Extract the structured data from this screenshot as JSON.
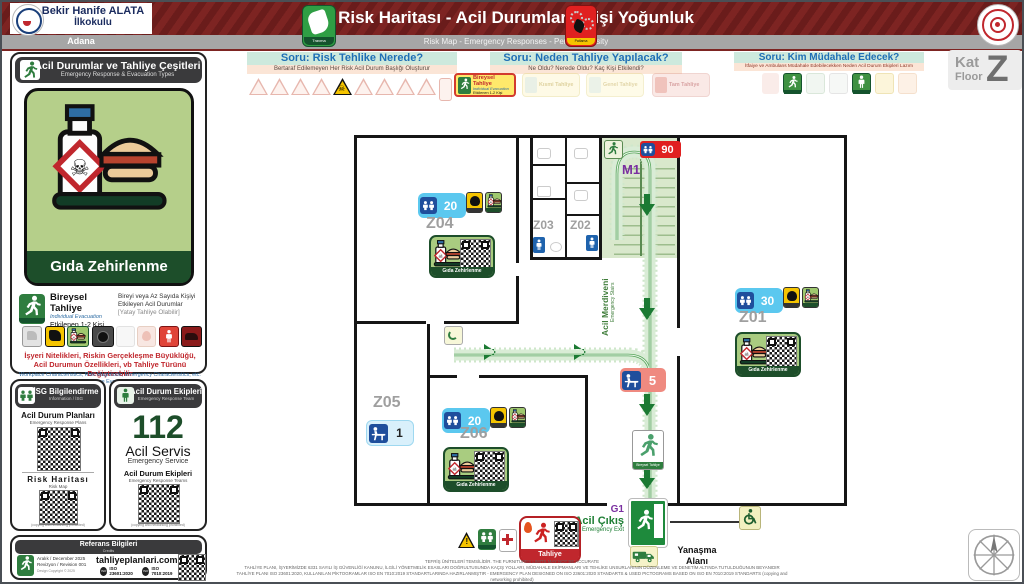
{
  "header": {
    "school_line1": "Bekir Hanife ALATA",
    "school_line2": "İlkokulu",
    "city": "Adana",
    "title": "Risk Haritası - Acil Durumlar - Kişi Yoğunluk",
    "subtitle": "Risk Map - Emergency Responses - Person Density",
    "travma_label": "Travma",
    "patlama_label": "Patlama"
  },
  "floor_badge": {
    "kat": "Kat",
    "floor": "Floor",
    "letter": "Z"
  },
  "questions": [
    {
      "title": "Soru: Risk Tehlike Nerede?",
      "subtitle": "Bertaraf Edilemeyen Her Risk Acil Durum Başlığı Oluşturur"
    },
    {
      "title": "Soru: Neden Tahliye Yapılacak?",
      "subtitle": "Ne Oldu? Nerede Oldu? Kaç Kişi Etkilendi?"
    },
    {
      "title": "Soru: Kim Müdahale Edecek?",
      "subtitle": "İtfaiye ve Ambulans Müdahale Edebilecekken Neden Acil Durum Ekipleri Lazım"
    }
  ],
  "evac_chips": {
    "active": {
      "title": "Bireysel Tahliye",
      "subtitle": "Individual Evacuation",
      "detail": "Etkilenen 1-2 Kişi"
    },
    "faded1": {
      "title": "Kısmi Tahliye"
    },
    "faded2": {
      "title": "Genel Tahliye"
    },
    "faded3": {
      "title": "Tam Tahliye"
    }
  },
  "sidebar": {
    "types": {
      "title": "Acil Durumlar ve Tahliye Çeşitleri",
      "subtitle": "Emergency Response & Evacuation Types",
      "hazard_label": "Gıda Zehirlenme",
      "evac_title": "Bireysel Tahliye",
      "evac_subtitle": "Individual Evacuation",
      "evac_detail": "Etkilenen 1-2 Kişi",
      "evac_desc1": "Bireyi veya Az Sayıda Kişiyi",
      "evac_desc2": "Etkileyen Acil Durumlar",
      "evac_desc3": "[Yatay Tahliye Olabilir]",
      "note_tr1": "İşyeri Nitelikleri, Riskin Gerçekleşme Büyüklüğü,",
      "note_tr2": "Acil Durumun Özellikleri, vb Tahliye Türünü Değiştirebilir",
      "note_en1": "Workplace Characteristics, Risk Magnitude, Emergency Characteristics, etc.",
      "note_en2": "May Change Evacuation Type"
    },
    "isg": {
      "title": "İSG Bilgilendirme",
      "subtitle": "Information / İSG",
      "plans_title": "Acil Durum Planları",
      "plans_subtitle": "Emergency Response Plans",
      "risk_title": "Risk Haritası",
      "risk_subtitle": "Risk Map",
      "copy_note": "(copying and networking prohibited)"
    },
    "team": {
      "title": "Acil Durum Ekipleri",
      "subtitle": "Emergency Response Team",
      "number": "112",
      "service": "Acil Servis",
      "service_en": "Emergency Service",
      "teams_title": "Acil Durum Ekipleri",
      "teams_subtitle": "Emergency Response Teams",
      "copy_note": "(copying and networking prohibited)"
    },
    "credits": {
      "title": "Referans Bilgileri",
      "subtitle": "Credits",
      "date": "Aralık / December 2025",
      "revision": "Revizyon / Revision 001",
      "copyright": "Design Copyright © 2025",
      "website": "tahliyeplanlari.com",
      "iso1": "ISO 23601:2020",
      "iso2": "ISO 7010:2019"
    }
  },
  "plan": {
    "rooms": [
      {
        "id": "Z01",
        "occupancy": "30"
      },
      {
        "id": "Z02"
      },
      {
        "id": "Z03"
      },
      {
        "id": "Z04",
        "occupancy": "20"
      },
      {
        "id": "Z05",
        "occupancy": "1"
      },
      {
        "id": "Z06",
        "occupancy": "20"
      }
    ],
    "stairs": {
      "id": "M1",
      "label_tr": "Acil Merdiveni",
      "label_en": "Emergency Stairs",
      "occupancy": "90"
    },
    "corridor_badge": "5",
    "exit": {
      "id": "G1",
      "label_tr": "Acil Çıkış",
      "label_en": "Emergency Exit"
    },
    "dock_line1": "Yanaşma",
    "dock_line2": "Alanı",
    "sticker_label": "Gıda Zehirlenme",
    "tahliye_label": "Tahliye",
    "sign_label": "Bireysel Tahliye"
  },
  "footer": {
    "line1": "TEFRİŞ ÜNİTELERİ TEMSİLİDİR. THE FURNITURES LIMITS MAY NOT BE ACCURATE",
    "line2": "TAHLİYE PLANI, İŞYERİMİZDE 6331 SAYILI İŞ GÜVENLİĞİ KANUNU, İLGİLİ YÖNETMELİK ESASLARI DOĞRULTUSUNDA KAÇIŞ YOLLARI, MÜDAHALE EKİPMANLARI VE TEHLİKE UNSURLARININ DÜZENLEME VE DENETİM ALTINDA TUTULDUĞUNUN BEYANIDIR",
    "line3": "TAHLİYE PLANI ISO 23601:2020, KULLANILAN PİKTOGRAMLAR ISO EN 7010:2019 STANDARTLARINDA HAZIRLANMIŞTIR - EMERGENCY PLAN DESIGNED ON ISO 23601:2020 STANDARTS & USED PICTOGRAMS BASED ON ISO EN 7010:2019 STANDARTS (copying and networking prohibited)"
  }
}
